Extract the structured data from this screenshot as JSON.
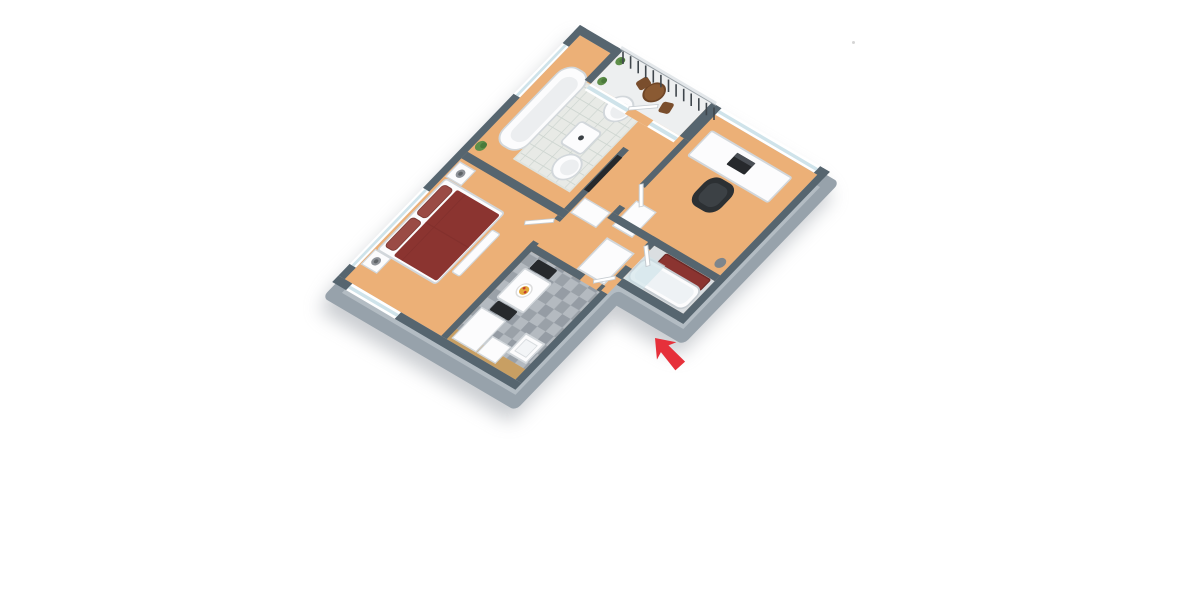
{
  "canvas": {
    "width": 1200,
    "height": 600,
    "background": "#ffffff"
  },
  "floorplan": {
    "type": "3d-floor-plan-render",
    "view": "axonometric, plan rotated ~45 degrees, apex at top, entrance lower-right",
    "colors": {
      "wall_top": "#56656f",
      "wall_side": "#97a2ab",
      "slab": "#b3bcc3",
      "floor_main": "#ecb077",
      "floor_balcony": "#edeff0",
      "floor_bathroom": "#dadee1",
      "tile_light": "#b4bac0",
      "tile_dark": "#959ca4",
      "wood": "#c89f63",
      "rug": "#e8eae6",
      "rug_grid": "#ccd4cf",
      "glass": "#cfe3ea",
      "white_furniture": "#fcfcfd",
      "furniture_border": "#d2d7db",
      "seat_inner": "#eceef0",
      "bed_duvet": "#8b3430",
      "bed_pillow": "#9a4b45",
      "bed_dark_edge": "#6e2a27",
      "dark_item": "#26292c",
      "chair_dark": "#2c3033",
      "chair_dark_inner": "#3c4145",
      "metal_gray": "#8e9298",
      "metal_dark": "#5f6468",
      "bin_gray": "#7d858c",
      "plant": "#5f8f4a",
      "plant_dark": "#4a7a3b",
      "balcony_table": "#8a5a33",
      "balcony_table_edge": "#6e4526",
      "balcony_chair": "#7a4e2d",
      "railing_post": "#3f464c",
      "railing_rail": "#e3e7ea",
      "arrow_red": "#e6303a",
      "plate_food": "#e2a93b",
      "plate_food_bits": "#c23b2e",
      "artifact": "#b3b3b3"
    },
    "rooms": [
      {
        "id": "living-room",
        "floor": "orange",
        "furniture": [
          "curved white sofa",
          "egg chair",
          "egg chair",
          "white coffee table",
          "grid rug",
          "tv",
          "plant",
          "plant"
        ]
      },
      {
        "id": "balcony",
        "floor": "light deck",
        "furniture": [
          "railing",
          "round wood table",
          "folding chair",
          "folding chair",
          "plant"
        ]
      },
      {
        "id": "office",
        "floor": "orange",
        "furniture": [
          "white desk under window",
          "laptop",
          "black office chair",
          "waste bin"
        ]
      },
      {
        "id": "bathroom",
        "floor": "gray",
        "furniture": [
          "bathtub",
          "shower glass",
          "dark red sideboard"
        ]
      },
      {
        "id": "bedroom",
        "floor": "orange",
        "furniture": [
          "double bed dark red duvet",
          "pillow",
          "pillow",
          "nightstand",
          "nightstand",
          "lamp",
          "lamp",
          "foot bench"
        ]
      },
      {
        "id": "kitchen",
        "floor": "gray checker tile + wood strip",
        "furniture": [
          "white dining table",
          "plate of food",
          "black chair",
          "black chair",
          "counter unit",
          "counter unit",
          "white floor unit"
        ]
      },
      {
        "id": "hallway",
        "floor": "orange",
        "furniture": [
          "wardrobe",
          "cabinet",
          "cabinet",
          "entrance door"
        ]
      }
    ],
    "windows": [
      "living-room NW",
      "bedroom NW",
      "bedroom SW",
      "office NE",
      "living-balcony glass wall"
    ],
    "doors": [
      "bedroom",
      "bathroom",
      "office",
      "entrance",
      "balcony"
    ],
    "entrance": {
      "marker": "red-arrow",
      "direction": "pointing up-left toward entrance door"
    },
    "balcony_railing": {
      "posts": 13
    },
    "artifact_dot": {
      "note": "tiny gray speck top right"
    }
  }
}
